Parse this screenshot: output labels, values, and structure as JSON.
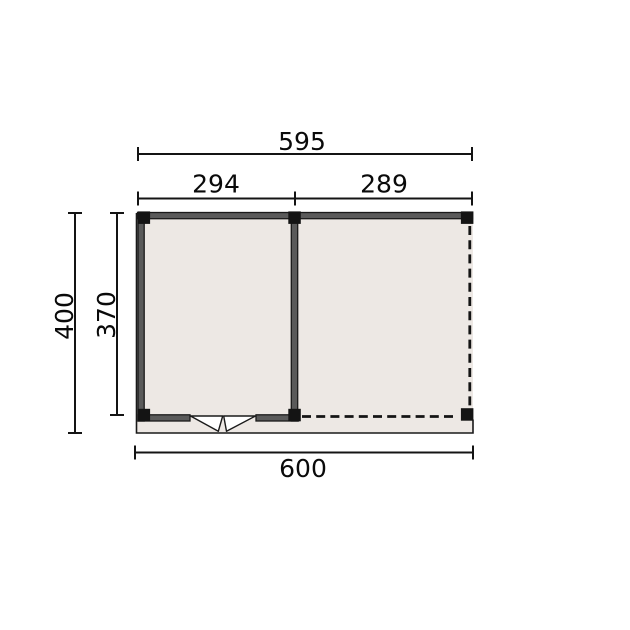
{
  "drawing": {
    "type": "floor-plan",
    "description": "Technical top-view plan of a two-section outbuilding: closed left room with double door, open right section with dashed (open) walls, on a base slab",
    "dimension_labels": {
      "overall_width": "595",
      "section_left_width": "294",
      "section_right_width": "289",
      "total_depth": "400",
      "inner_depth": "370",
      "base_width": "600"
    },
    "colors": {
      "background": "#ffffff",
      "floor_fill": "#ede8e4",
      "wall_fill": "#5a5a5a",
      "line": "#1a1a1a",
      "post": "#141414",
      "door_fill": "#ffffff"
    }
  }
}
